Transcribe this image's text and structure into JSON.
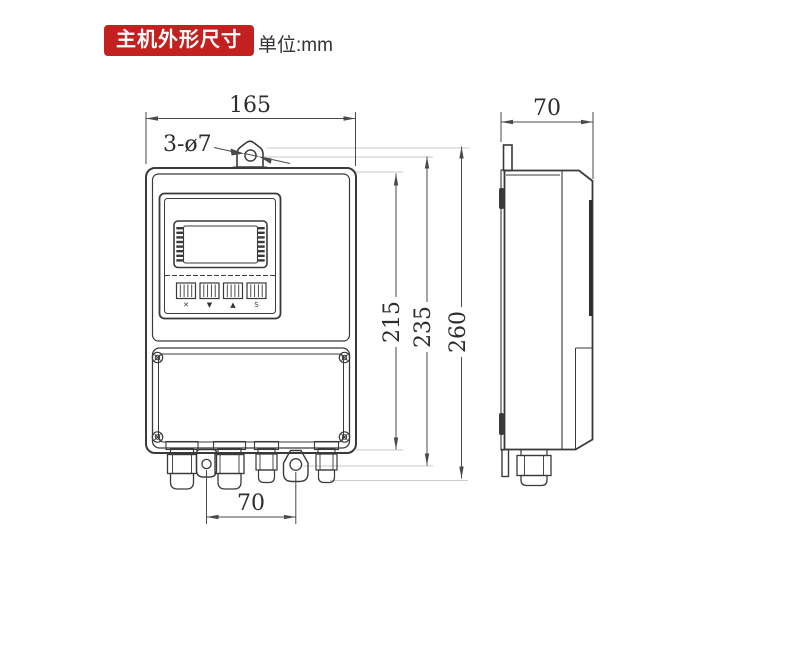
{
  "header": {
    "badge_label": "主机外形尺寸",
    "unit_label": "单位:mm",
    "badge_color": "#c2211f"
  },
  "diagram": {
    "front_view": {
      "dim_width": "165",
      "dim_mount_holes": "3-ø7",
      "dim_body_height": "215",
      "dim_hole_height": "235",
      "dim_total_height": "260",
      "dim_bottom_hole_spacing": "70",
      "keypad_keys": [
        "✕",
        "▼",
        "▲",
        "S"
      ]
    },
    "side_view": {
      "dim_depth": "70"
    },
    "colors": {
      "line": "#3a3a3a",
      "dimension": "#4a4a4a",
      "projection": "#b8b8b8"
    }
  }
}
